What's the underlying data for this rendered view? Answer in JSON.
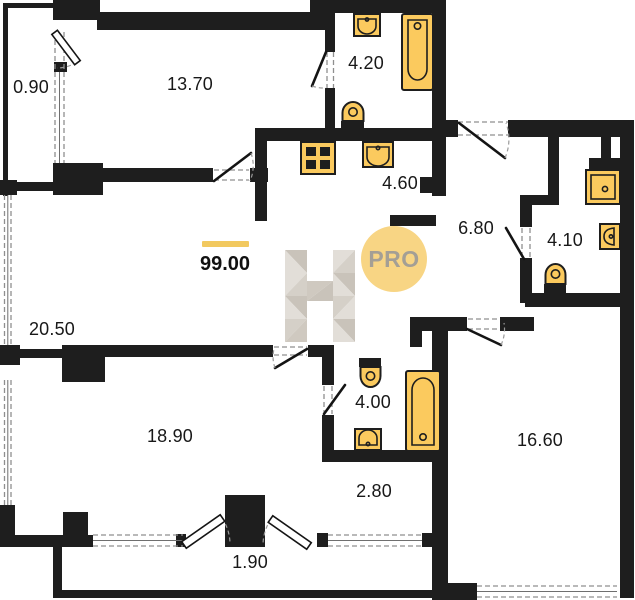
{
  "plan": {
    "total_area": "99.00",
    "rooms": [
      {
        "name": "balcony-top",
        "area": "0.90"
      },
      {
        "name": "room-13-70",
        "area": "13.70"
      },
      {
        "name": "bathroom-4-20",
        "area": "4.20"
      },
      {
        "name": "kitchen-4-60",
        "area": "4.60"
      },
      {
        "name": "hall-6-80",
        "area": "6.80"
      },
      {
        "name": "bathroom-4-10",
        "area": "4.10"
      },
      {
        "name": "living-20-50",
        "area": "20.50"
      },
      {
        "name": "room-18-90",
        "area": "18.90"
      },
      {
        "name": "bathroom-4-00",
        "area": "4.00"
      },
      {
        "name": "corridor-2-80",
        "area": "2.80"
      },
      {
        "name": "room-16-60",
        "area": "16.60"
      },
      {
        "name": "balcony-bottom",
        "area": "1.90"
      }
    ],
    "watermark": {
      "letter": "H",
      "badge": "PRO"
    },
    "icons": [
      "bathtub-icon",
      "sink-icon",
      "toilet-icon",
      "stove-icon",
      "shower-icon"
    ],
    "colors": {
      "wall": "#1e1e1e",
      "fixture": "#fbca5e",
      "accent_bar": "#f2c95f",
      "badge_bg": "#f8d584",
      "badge_text": "#a49f95",
      "watermark_light": "#e2ded8",
      "watermark_mid": "#d5d0c8",
      "watermark_dark": "#c9c3ba"
    }
  }
}
